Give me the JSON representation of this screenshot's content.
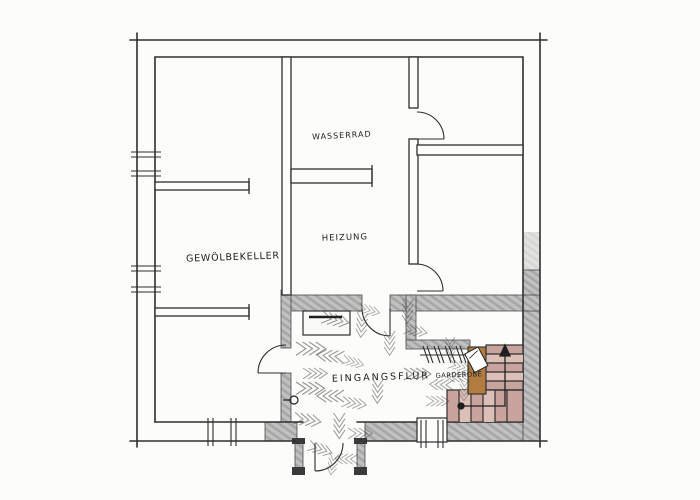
{
  "floorplan": {
    "title": "Hand-drawn floor plan sketch (cellar / entrance level)",
    "rooms": [
      {
        "name": "WASSERRAD"
      },
      {
        "name": "HEIZUNG"
      },
      {
        "name": "GEWÖLBEKELLER"
      },
      {
        "name": "EINGANGSFLUR"
      },
      {
        "name": "GARDEROBE"
      }
    ],
    "symbols": {
      "stair_direction": "up-arrow",
      "floor_texture": "herringbone-hatching",
      "coat_rack": "wall hooks",
      "windows": "double-tick wall symbols",
      "doors": "quarter-circle swings"
    },
    "colors": {
      "paper": "#fcfcfa",
      "line": "#2e2e2e",
      "wall_fill": "#b8b8b8",
      "stair_fill": "#c9a49f",
      "stair_fill_alt": "#dcc0b8",
      "wood_fill": "#b07c3f",
      "hatch": "#3f3f3f"
    }
  }
}
